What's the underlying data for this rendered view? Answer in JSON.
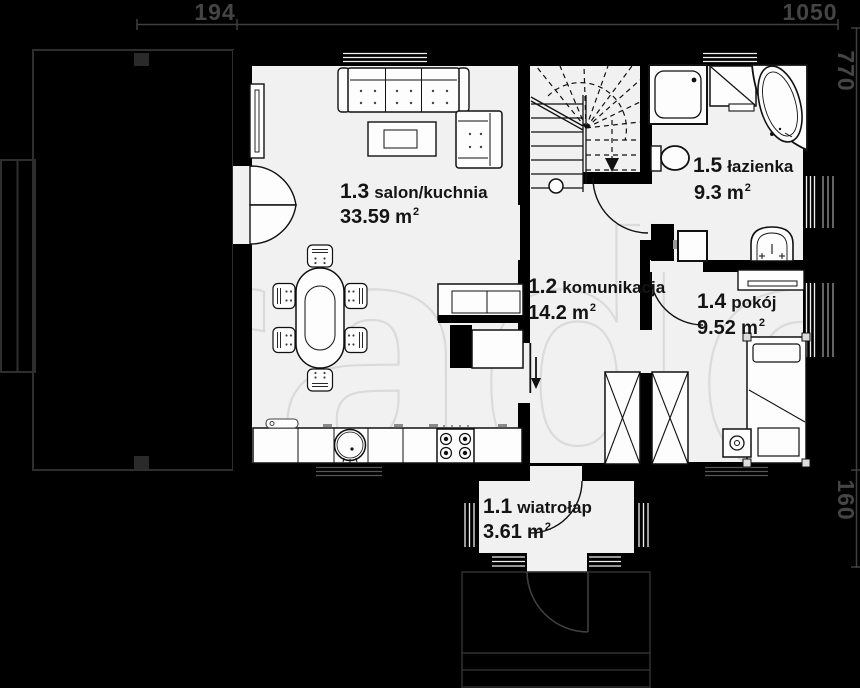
{
  "dimensions": {
    "top_segment_small": "194",
    "top_segment_large": "1050",
    "right_height": "770",
    "right_porch": "160"
  },
  "rooms": [
    {
      "number": "1.1",
      "name": "wiatrołap",
      "area": "3.61",
      "unit": "m",
      "exp": "2"
    },
    {
      "number": "1.2",
      "name": "komunikacja",
      "area": "14.2",
      "unit": "m",
      "exp": "2"
    },
    {
      "number": "1.3",
      "name": "salon/kuchnia",
      "area": "33.59",
      "unit": "m",
      "exp": "2"
    },
    {
      "number": "1.4",
      "name": "pokój",
      "area": "9.52",
      "unit": "m",
      "exp": "2"
    },
    {
      "number": "1.5",
      "name": "łazienka",
      "area": "9.3",
      "unit": "m",
      "exp": "2"
    }
  ],
  "watermark": {
    "text": "radom"
  },
  "colors": {
    "background": "#000000",
    "room_fill": "#f1f1f1",
    "furniture_fill": "#fdfdfd",
    "outline_gray": "#2e2e2e",
    "dim_text": "#454545",
    "window_line": "#efefef"
  }
}
